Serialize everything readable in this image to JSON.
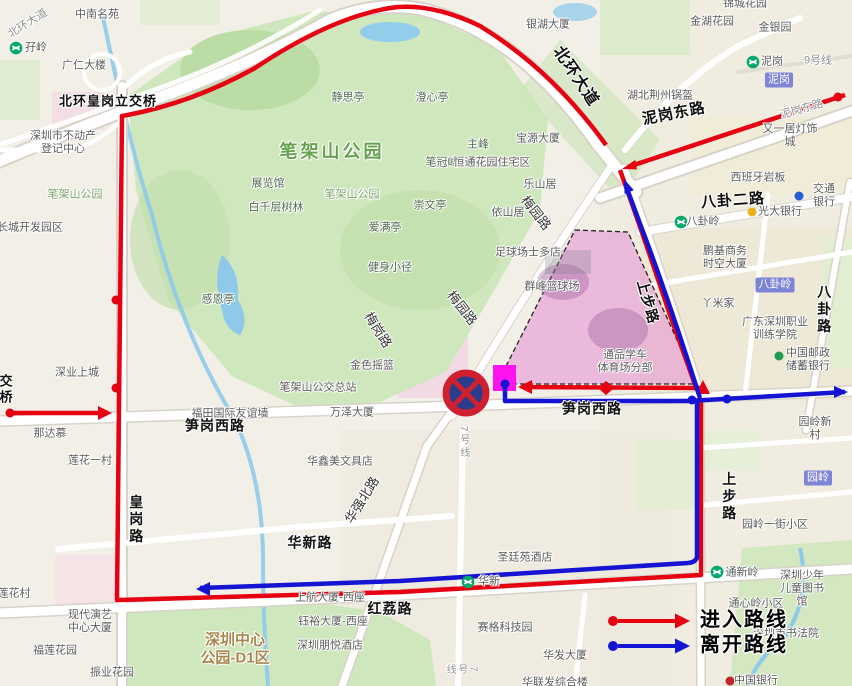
{
  "legend": {
    "enter": "进入路线",
    "leave": "离开路线"
  },
  "colors": {
    "enter_route": "#e60011",
    "leave_route": "#1414d2",
    "venue_fill": "#e484d0",
    "gate": "#ff12f0",
    "no_parking_ring": "#cf2030",
    "no_parking_disc": "#2a3c8c",
    "park_green": "#cfe7bd",
    "water_blue": "#8fc9ea"
  },
  "labels": {
    "zhongnan": "中南名苑",
    "ziling": "孖岭",
    "guangren": "广仁大楼",
    "lijiaoqiao": "北环皇岗立交桥",
    "budongchan": "深圳市不动产\n登记中心",
    "changcheng": "长城开发园区",
    "bjs_small_w": "笔架山公园",
    "zhanlanguan": "展览馆",
    "baiqianceng": "白千层树林",
    "jingsiting": "静思亭",
    "chengxinting": "澄心亭",
    "bjs_big": "笔架山公园",
    "zhufeng": "主峰",
    "biguanfeng": "笔冠峰",
    "baoyuan": "宝源大厦",
    "hengtong": "恒通花园住宅区",
    "leshanju": "乐山居",
    "yishanju": "依山居",
    "chongwenting": "崇文亭",
    "bjs_small_c": "笔架山公园",
    "aimanting": "爱满亭",
    "jianshen": "健身小径",
    "ganenting": "感恩亭",
    "meiganglu": "梅岗路",
    "jinseyaolan": "金色摇篮",
    "bjs_bus": "笔架山公交总站",
    "wanze": "万泽大厦",
    "youyiqiang": "福田国际友谊墙",
    "sungang_w": "笋岗西路",
    "sungang_c": "笋岗西路",
    "nadamu": "那达慕",
    "lianhua_yicun": "莲花一村",
    "shenye": "深业上城",
    "huaxinmei": "华鑫美文具店",
    "huaqiangbei": "华强北路",
    "huaxinlu": "华新路",
    "line7": "7号线",
    "line7b": "7号线",
    "honglilu": "红荔路",
    "huangganglu": "皇岗路",
    "lianhuacun": "莲花村",
    "xiandaiyanyi": "现代演艺\n中心大厦",
    "fulian": "福莲花园",
    "zhenye": "振业花园",
    "zxgy": "深圳中心\n公园-D1区",
    "shanghang": "上航大厦-西座",
    "yuyu": "钰裕大厦-西座",
    "pengyue": "深圳朋悦酒店",
    "shengtingyuan": "圣廷苑酒店",
    "saige": "赛格科技园",
    "huafa": "华发大厦",
    "hualianfa": "华联发综合楼",
    "huaxin_st": "华新",
    "tongxinling_st": "通新岭",
    "ertong": "深圳少年\n儿童图书馆",
    "shufayuan": "深圳市书法院",
    "tongxinling_xq": "通心岭小区",
    "zhongguoyinhang": "中国银行",
    "yuanling_badge": "园岭",
    "yuanling_yijie": "园岭一街小区",
    "yuanling_xincun": "园岭新村",
    "shangbu_s": "上步路",
    "shangbu_n": "上步路",
    "youzheng": "中国邮政\n储蓄银行",
    "zhiye": "广东深圳职业\n训练学院",
    "yamijia": "丫米家",
    "baguling_badge": "八卦岭",
    "bagualu": "八卦路",
    "pengji": "鹏基商务\n时空大厦",
    "baguling_st": "八卦岭",
    "guangda": "光大银行",
    "baguaer": "八卦二路",
    "jiaotong": "交通银行",
    "xibanya": "西班牙岩板",
    "dengshi": "又一居灯饰城",
    "nigangdong_big": "泥岗东路",
    "nigangdong_small": "泥岗东路",
    "hubei": "湖北荆州锅盔",
    "nigang_badge": "泥岗",
    "nigang_st": "泥岗",
    "line9": "9号线",
    "jinyin": "金银园",
    "jinhu": "金湖花园",
    "jincheng": "锦城花园",
    "yinhu": "银湖大厦",
    "beihuan_big": "北环大道",
    "beihuan_small": "北环大道",
    "meiyuan1": "梅园路",
    "meiyuan2": "梅园路",
    "jiaoqiao": "交桥",
    "venue_zuqiu": "足球场士多店",
    "venue_qunfeng": "群峰篮球场",
    "venue_tongpin": "通品学车\n体育场分部"
  }
}
